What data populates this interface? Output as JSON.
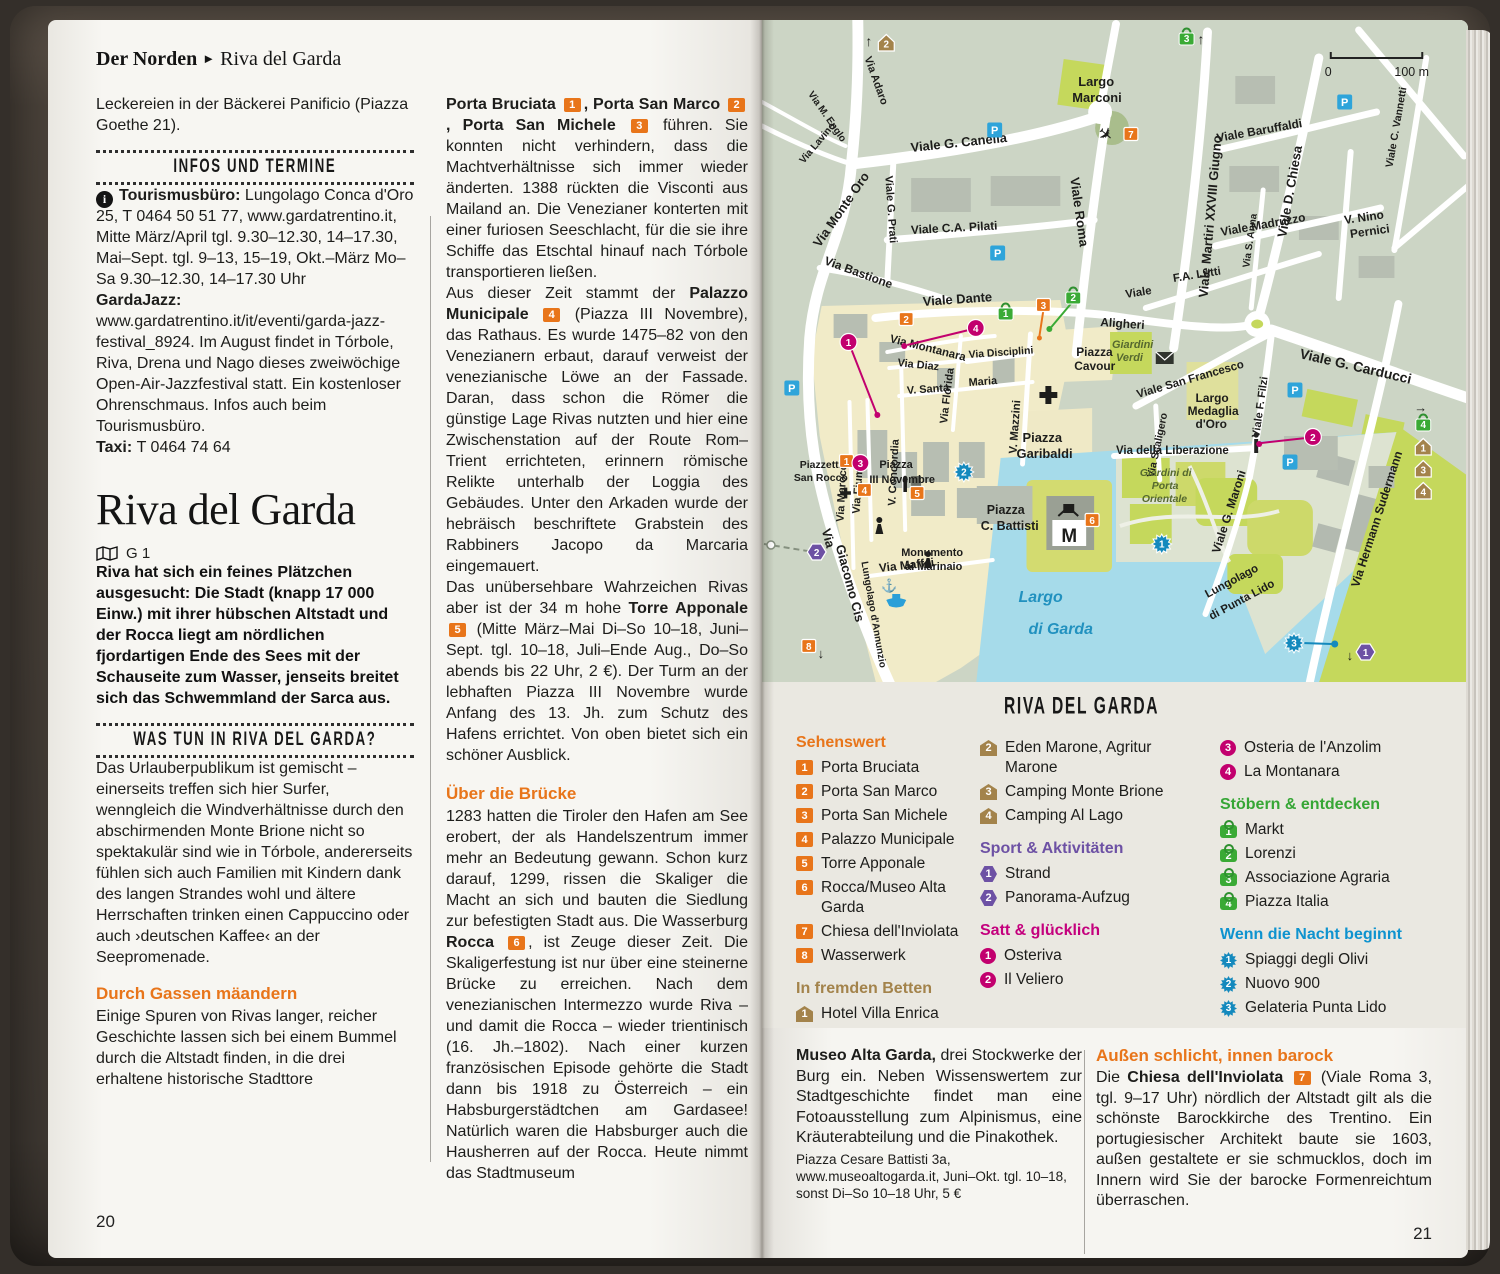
{
  "page_left": {
    "number": "20",
    "header": {
      "section": "Der Norden",
      "arrow": "►",
      "title": "Riva del Garda"
    },
    "col1": {
      "intro": "Leckereien in der Bäckerei Panificio (Piazza Goethe 21).",
      "infos_title": "INFOS UND TERMINE",
      "item_tourismus": [
        {
          "t": "Tourismusbüro: ",
          "b": true
        },
        {
          "t": "Lungolago Conca d'Oro 25, T 0464 50 51 77, www.gardatrentino.it, Mitte März/April tgl. 9.30–12.30, 14–17.30, Mai–Sept. tgl. 9–13, 15–19, Okt.–März Mo–Sa 9.30–12.30, 14–17.30 Uhr"
        }
      ],
      "item_gardajazz": [
        {
          "t": "GardaJazz: ",
          "b": true
        },
        {
          "t": "www.gardatrentino.it/it/eventi/garda-jazz-festival_8924. Im August findet in Tórbole, Riva, Drena und Nago dieses zweiwöchige Open-Air-Jazzfestival statt. Ein kostenloser Ohrenschmaus. Infos auch beim Tourismusbüro."
        }
      ],
      "item_taxi": [
        {
          "t": "Taxi: ",
          "b": true
        },
        {
          "t": "T 0464 74 64"
        }
      ],
      "city_heading": "Riva del Garda",
      "map_ref": "G 1",
      "lead": "Riva hat sich ein feines Plätzchen ausgesucht: Die Stadt (knapp 17 000 Einw.) mit ihrer hübschen Altstadt und der Rocca liegt am nördlichen fjordartigen Ende des Sees mit der Schauseite zum Wasser, jenseits breitet sich das Schwemmland der Sarca aus.",
      "wastun_title": "WAS TUN IN RIVA DEL GARDA?",
      "wastun_text": "Das Urlauberpublikum ist gemischt – einerseits treffen sich hier Surfer, wenngleich die Windverhältnisse durch den abschirmenden Monte Brione nicht so spektakulär sind wie in Tórbole, andererseits fühlen sich auch Familien mit Kindern dank des langen Strandes wohl und ältere Herrschaften trinken einen Cappuccino oder auch ›deutschen Kaffee‹ an der Seepromenade.",
      "sub1_title": "Durch Gassen mäandern",
      "sub1_text": "Einige Spuren von Rivas langer, reicher Geschichte lassen sich bei einem Bummel durch die Altstadt finden, in die drei erhaltene historische Stadttore"
    },
    "col2": {
      "p1": [
        {
          "t": "Porta Bruciata ",
          "b": true
        },
        {
          "badge": "1"
        },
        {
          "t": ", ",
          "b": true
        },
        {
          "t": "Porta San Marco ",
          "b": true
        },
        {
          "badge": "2"
        },
        {
          "t": ", ",
          "b": true
        },
        {
          "t": "Porta San Michele ",
          "b": true
        },
        {
          "badge": "3"
        },
        {
          "t": " führen. Sie konnten nicht verhindern, dass die Machtverhältnisse sich immer wieder änderten. 1388 rückten die Visconti aus Mailand an. Die Venezianer konterten mit einer furiosen Seeschlacht, für die sie ihre Schiffe das Etschtal hinauf nach Tórbole transportieren ließen."
        }
      ],
      "p2": [
        {
          "t": "Aus dieser Zeit stammt der "
        },
        {
          "t": "Palazzo Municipale ",
          "b": true
        },
        {
          "badge": "4"
        },
        {
          "t": " (Piazza III Novembre), das Rathaus. Es wurde 1475–82 von den Venezianern erbaut, darauf verweist der venezianische Löwe an der Fassade. Daran, dass schon die Römer die günstige Lage Rivas nutzten und hier eine Zwischenstation auf der Route Rom–Trient errichteten, erinnern römische Relikte unterhalb der Loggia des Gebäudes. Unter den Arkaden wurde der hebräisch beschriftete Grabstein des Rabbiners Jacopo da Marcaria eingemauert."
        }
      ],
      "p3": [
        {
          "t": "Das unübersehbare Wahrzeichen Rivas aber ist der 34 m hohe "
        },
        {
          "t": "Torre Apponale ",
          "b": true
        },
        {
          "badge": "5"
        },
        {
          "t": " (Mitte März–Mai Di–So 10–18, Juni–Sept. tgl. 10–18, Juli–Ende Aug., Do–So abends bis 22 Uhr, 2 €). Der Turm an der lebhaften Piazza III Novembre wurde Anfang des 13. Jh. zum Schutz des Hafens errichtet. Von oben bietet sich ein schöner Ausblick."
        }
      ],
      "sub_title": "Über die Brücke",
      "p4": [
        {
          "t": "1283 hatten die Tiroler den Hafen am See erobert, der als Handelszentrum immer mehr an Bedeutung gewann. Schon kurz darauf, 1299, rissen die Skaliger die Macht an sich und bauten die Siedlung zur befestigten Stadt aus. Die Wasserburg "
        },
        {
          "t": "Rocca ",
          "b": true
        },
        {
          "badge": "6"
        },
        {
          "t": ", ist Zeuge dieser Zeit. Die Skaligerfestung ist nur über eine steinerne Brücke zu erreichen. Nach dem venezianischen Intermezzo wurde Riva – und damit die Rocca – wieder trientinisch (16. Jh.–1802). Nach einer kurzen französischen Episode gehörte die Stadt dann bis 1918 zu Österreich – ein Habsburgerstädtchen am Gardasee! Natürlich waren die Habsburger auch die Hausherren auf der Rocca. Heute nimmt das Stadtmuseum"
        }
      ]
    }
  },
  "page_right": {
    "number": "21",
    "map": {
      "labels": {
        "lm1": "Largo",
        "lm2": "Marconi",
        "canella": "Viale G. Canella",
        "monte_oro": "Via Monte Oro",
        "adaro": "Via Adaro",
        "englo": "Via M. Englo",
        "lavino": "Via Lavino",
        "pilati": "Viale C.A. Pilati",
        "prati": "Viale G. Prati",
        "roma": "Viale Roma",
        "martiri": "Viale Martiri XXVIII Giugno",
        "baruffaldi": "Viale Baruffaldi",
        "madruzzo": "Viale Madruzzo",
        "pernici1": "V. Nino",
        "pernici2": "Pernici",
        "dchiesa": "Viale D. Chiesa",
        "vannetti": "Viale C. Vannetti",
        "carducci": "Viale G. Carducci",
        "lutti_pre": "Viale",
        "lutti": "F.A. Lutti",
        "sanna": "Via S. Anna",
        "bastione": "Via Bastione",
        "dante": "Viale Dante",
        "aligheri": "Aligheri",
        "montanara": "Via Montanara",
        "diaz": "Via Diaz",
        "santa": "V. Santa",
        "maria": "Maria",
        "florida": "Via Florida",
        "disciplini": "Via Disciplini",
        "mazzini": "V. Mazzini",
        "cavour1": "Piazza",
        "cavour2": "Cavour",
        "verdi1": "Giardini",
        "verdi2": "Verdi",
        "marocco": "Via Marocco",
        "fiume": "Via Fiume",
        "concordia": "V. Concordia",
        "maffei": "Via Maffei",
        "garibaldi1": "Piazza",
        "garibaldi2": "Garibaldi",
        "sanfrancesco": "Viale San Francesco",
        "filzi": "Viale F. Filzi",
        "med1": "Largo",
        "med2": "Medaglia",
        "med3": "d'Oro",
        "scaligero": "Via Scaligero",
        "liberazione": "Via della Liberazione",
        "orient1": "Giardini di",
        "orient2": "Porta",
        "orient3": "Orientale",
        "piazzetta1": "Piazzetta",
        "piazzetta2": "San Rocco",
        "novembre1": "Piazza",
        "novembre2": "III Novembre",
        "battisti1": "Piazza",
        "battisti2": "C. Battisti",
        "marinaio1": "Monumento",
        "marinaio2": "al Marinaio",
        "largo1": "Largo",
        "largo2": "di Garda",
        "giacomo1": "Via",
        "giacomo2": "Giacomo Cis",
        "annunzio": "Lungolago d'Annunzio",
        "maroni": "Viale G. Maroni",
        "sudermann": "Via Hermann Sudermann",
        "punta1": "Lungolago",
        "punta2": "di Punta Lido",
        "scale0": "0",
        "scale100": "100 m"
      },
      "icons": {
        "parking": "P",
        "museum": "M",
        "plane": "✈",
        "anchor": "⚓",
        "info": "i",
        "arrow_up": "↑",
        "arrow_down": "↓",
        "arrow_right": "→"
      }
    },
    "legend": {
      "map_title": "RIVA DEL GARDA",
      "sehenswert_title": "Sehenswert",
      "sehenswert": [
        {
          "n": "1",
          "label": "Porta Bruciata"
        },
        {
          "n": "2",
          "label": "Porta San Marco"
        },
        {
          "n": "3",
          "label": "Porta San Michele"
        },
        {
          "n": "4",
          "label": "Palazzo Municipale"
        },
        {
          "n": "5",
          "label": "Torre Apponale"
        },
        {
          "n": "6",
          "label": "Rocca/Museo Alta Garda"
        },
        {
          "n": "7",
          "label": "Chiesa dell'Inviolata"
        },
        {
          "n": "8",
          "label": "Wasserwerk"
        }
      ],
      "betten_title": "In fremden Betten",
      "betten": [
        {
          "n": "1",
          "label": "Hotel Villa Enrica"
        },
        {
          "n": "2",
          "label": "Eden Marone, Agritur Marone"
        },
        {
          "n": "3",
          "label": "Camping Monte Brione"
        },
        {
          "n": "4",
          "label": "Camping Al Lago"
        }
      ],
      "sport_title": "Sport & Aktivitäten",
      "sport": [
        {
          "n": "1",
          "label": "Strand"
        },
        {
          "n": "2",
          "label": "Panorama-Aufzug"
        }
      ],
      "satt_title": "Satt & glücklich",
      "satt": [
        {
          "n": "1",
          "label": "Osteriva"
        },
        {
          "n": "2",
          "label": "Il Veliero"
        },
        {
          "n": "3",
          "label": "Osteria de l'Anzolim"
        },
        {
          "n": "4",
          "label": "La Montanara"
        }
      ],
      "stoebern_title": "Stöbern & entdecken",
      "stoebern": [
        {
          "n": "1",
          "label": "Markt"
        },
        {
          "n": "2",
          "label": "Lorenzi"
        },
        {
          "n": "3",
          "label": "Associazione Agraria"
        },
        {
          "n": "4",
          "label": "Piazza Italia"
        }
      ],
      "nacht_title": "Wenn die Nacht beginnt",
      "nacht": [
        {
          "n": "1",
          "label": "Spiaggi degli Olivi"
        },
        {
          "n": "2",
          "label": "Nuovo 900"
        },
        {
          "n": "3",
          "label": "Gelateria Punta Lido"
        }
      ]
    },
    "box_left": {
      "segments": [
        {
          "t": "Museo Alta Garda, ",
          "b": true
        },
        {
          "t": "drei Stockwerke der Burg ein. Neben Wissenswertem zur Stadtgeschichte findet man eine Fotoausstellung zum Alpinismus, eine Kräuterabteilung und die Pinakothek."
        }
      ],
      "details": "Piazza Cesare Battisti 3a, www.museoaltogarda.it, Juni–Okt. tgl. 10–18, sonst Di–So 10–18 Uhr, 5 €"
    },
    "box_right": {
      "title": "Außen schlicht, innen barock",
      "segments": [
        {
          "t": "Die "
        },
        {
          "t": "Chiesa dell'Inviolata ",
          "b": true
        },
        {
          "badge": "7"
        },
        {
          "t": " (Viale Roma 3, tgl. 9–17 Uhr) nördlich der Altstadt gilt als die schönste Barockkirche des Trentino. Ein portugiesischer Architekt baute sie 1603, außen gestaltete er sie schmucklos, doch im Innern wird Sie der barocke Formenreichtum überraschen."
        }
      ]
    }
  }
}
